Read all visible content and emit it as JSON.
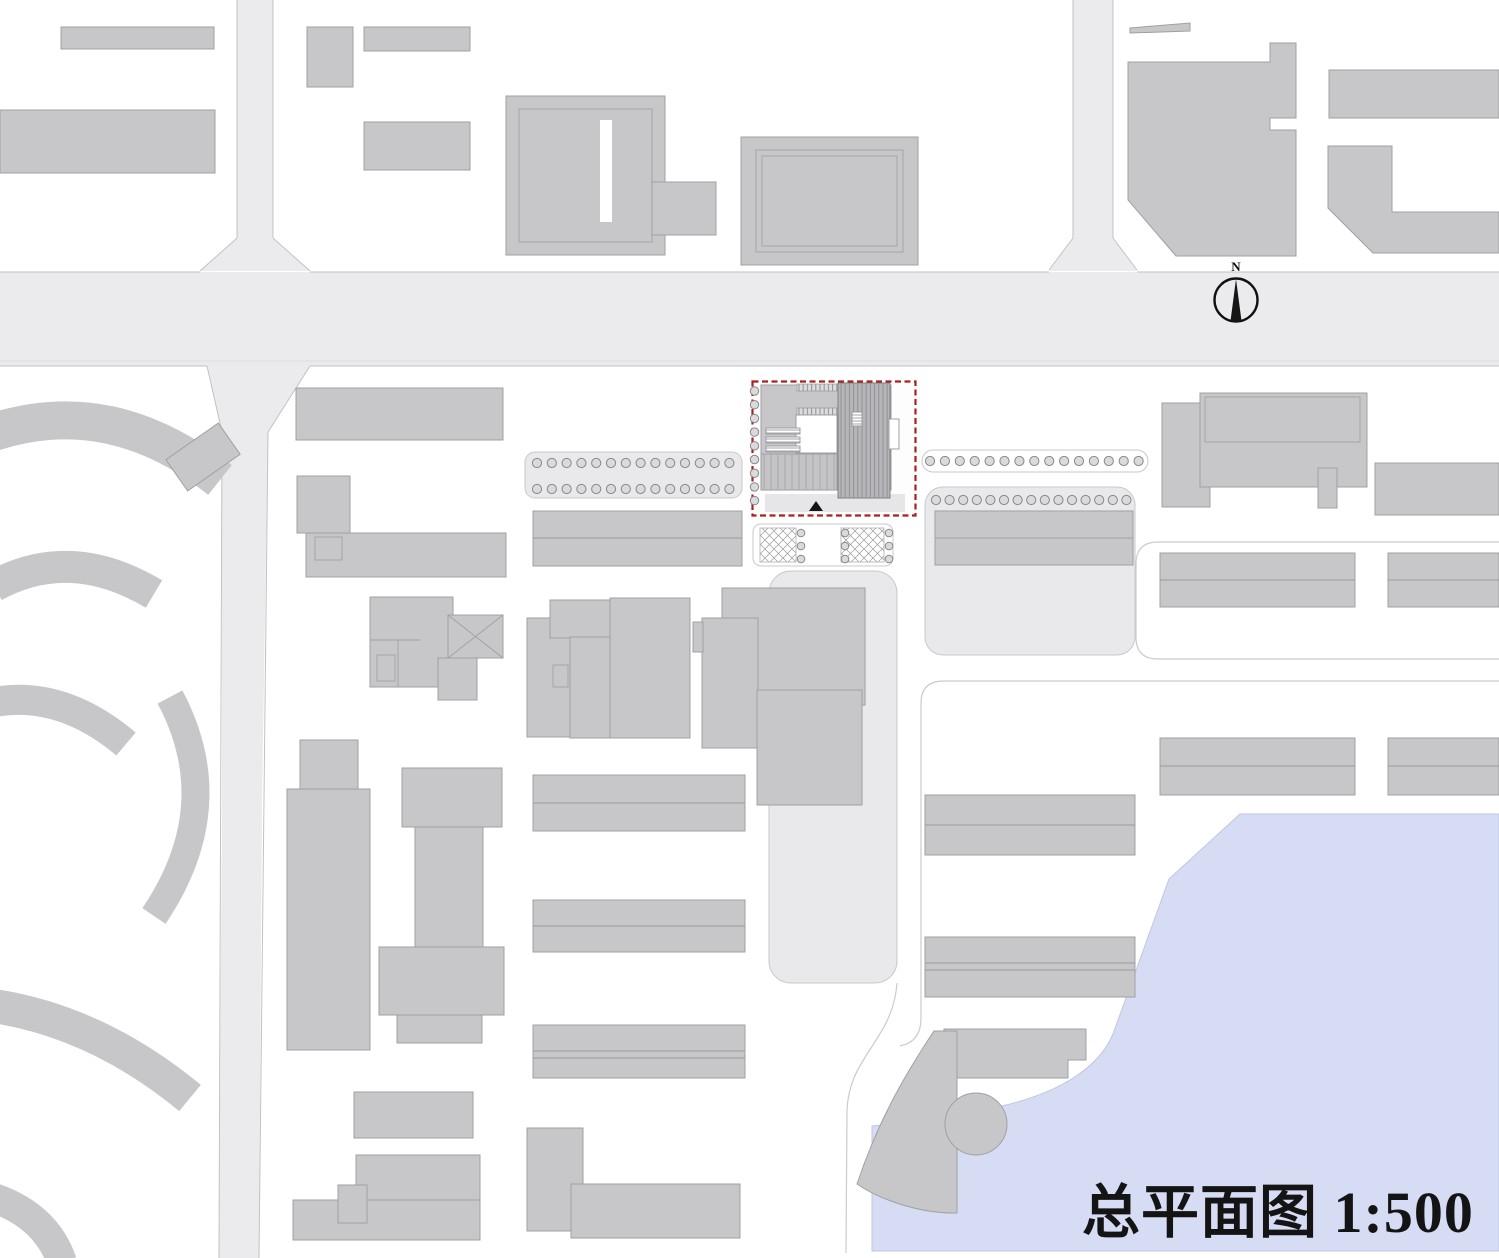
{
  "drawing": {
    "kind": "architectural site plan",
    "title_text": "总平面图 1:500",
    "scale_label": "1:500",
    "compass_label": "N"
  },
  "colors": {
    "background": "#ffffff",
    "road_fill": "#ebebed",
    "road_edge": "#c2c2c4",
    "building_fill": "#c7c7c9",
    "building_stroke": "#a0a0a3",
    "building_dark": "#b6b6b9",
    "pad_fill": "#e9e9eb",
    "pad_stroke": "#c9c9cb",
    "outline": "#cbcbcd",
    "tree_fill": "#dadadc",
    "tree_stroke": "#88888b",
    "water_fill": "#d5dcf4",
    "water_edge": "#bfc6e0",
    "site_border": "#a8211f",
    "ink": "#141414"
  },
  "tree_rows": [
    {
      "x0": 537,
      "y0": 463,
      "dx": 14.8,
      "dy": 0,
      "n": 14,
      "r": 4.6
    },
    {
      "x0": 537,
      "y0": 489,
      "dx": 14.8,
      "dy": 0,
      "n": 14,
      "r": 4.6
    },
    {
      "x0": 930,
      "y0": 461,
      "dx": 14.9,
      "dy": 0,
      "n": 15,
      "r": 4.6
    },
    {
      "x0": 936,
      "y0": 500,
      "dx": 13.6,
      "dy": 0,
      "n": 15,
      "r": 4.6
    },
    {
      "x0": 754.5,
      "y0": 391,
      "dx": 0,
      "dy": 13.7,
      "n": 9,
      "r": 4.2
    },
    {
      "x0": 801,
      "y0": 533,
      "dx": 44,
      "dy": 0,
      "n": 3,
      "r": 3.8
    },
    {
      "x0": 801,
      "y0": 546,
      "dx": 44,
      "dy": 0,
      "n": 3,
      "r": 3.8
    },
    {
      "x0": 801,
      "y0": 559,
      "dx": 44,
      "dy": 0,
      "n": 3,
      "r": 3.8
    }
  ]
}
